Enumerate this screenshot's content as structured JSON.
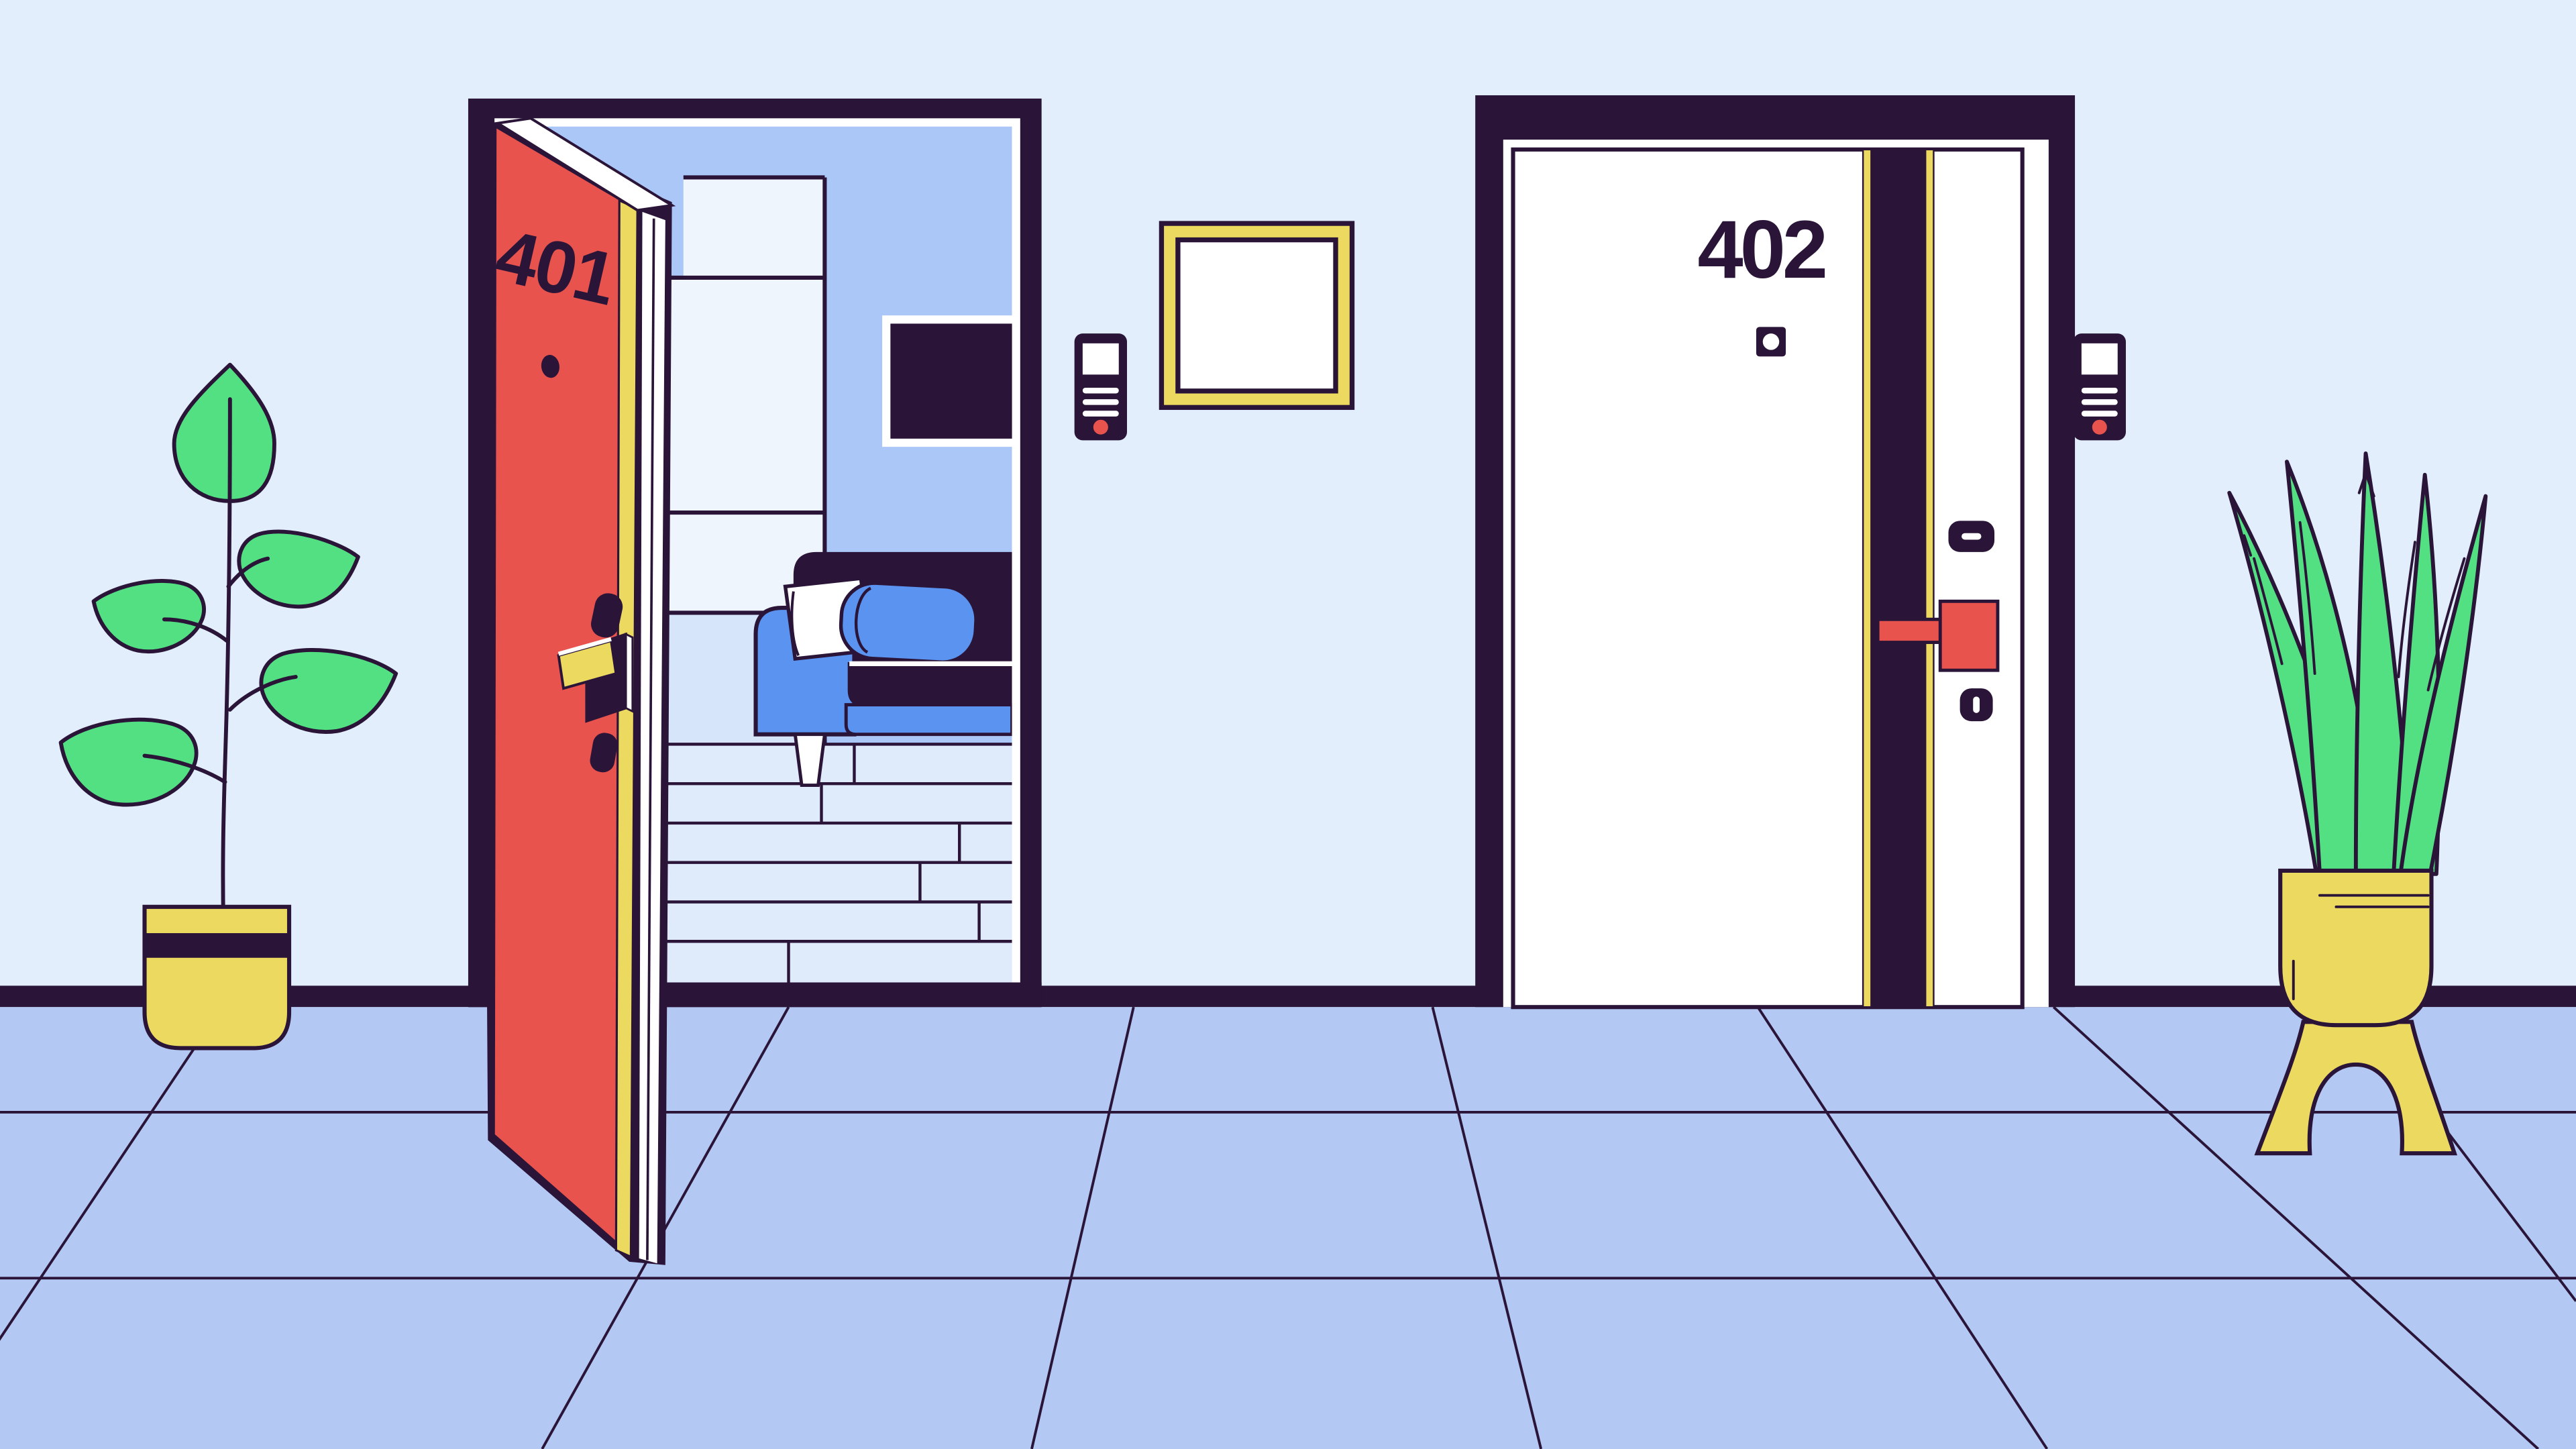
{
  "scene": {
    "type": "flat line-art illustration",
    "setting": "apartment hallway, fourth floor, with two apartment doors",
    "door_401": {
      "number": "401",
      "state": "open",
      "panel_color": "#e8534e"
    },
    "door_402": {
      "number": "402",
      "state": "closed",
      "panel_color": "#ffffff"
    },
    "palette": {
      "outline": "#2a1539",
      "hall_wall": "#e2eefc",
      "hall_floor": "#b3c9f4",
      "interior_wall": "#abc7f7",
      "wardrobe_white": "#eef5fd",
      "cabinet_blue": "#d7e5fa",
      "plank_wall": "#dfeafb",
      "accent_red": "#e8534e",
      "accent_yellow": "#ecd960",
      "accent_blue": "#5a94f0",
      "leaf_green": "#52e082",
      "white": "#ffffff"
    },
    "objects": {
      "left_plant": "potted broadleaf plant in yellow striped pot",
      "right_plant": "aloe plant in yellow pot on arched stand",
      "picture_frame": "empty yellow wall frame",
      "intercom_401": "door phone with call button beside door 401",
      "intercom_402": "door phone with call button beside door 402",
      "interior_room": "living room with wardrobe, wall tv, couch with pillows and plank wall"
    }
  }
}
